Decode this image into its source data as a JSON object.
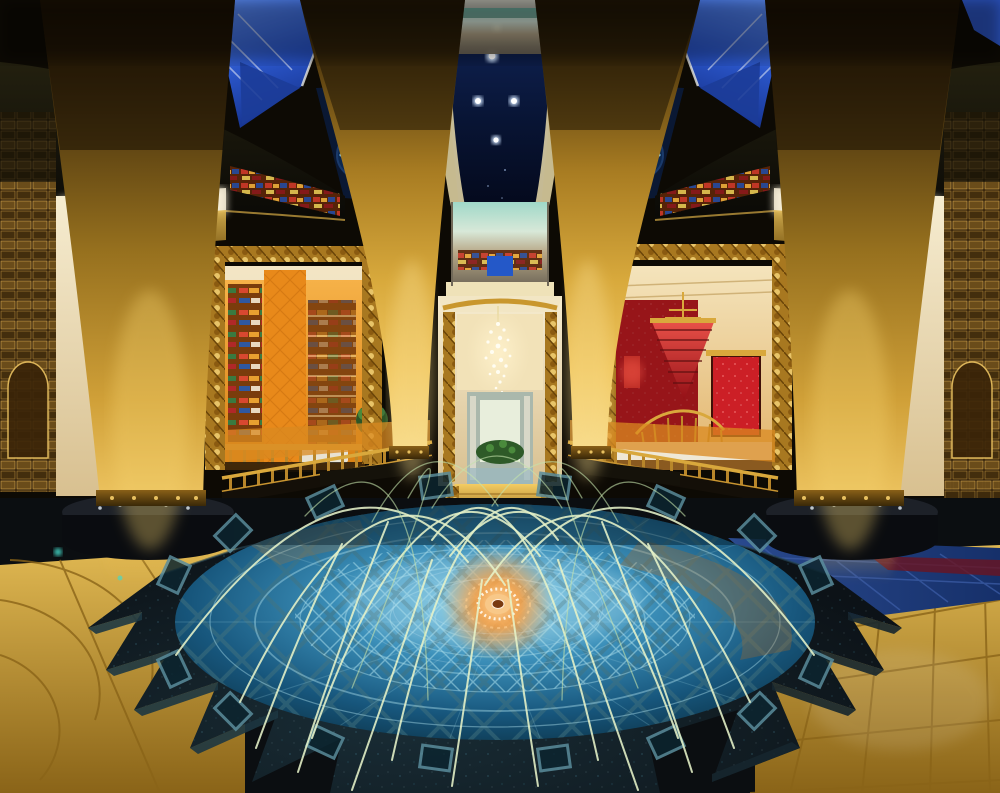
{
  "scene": {
    "type": "photograph",
    "subject": "luxury-hotel-atrium-lobby-with-fountain",
    "counts": {
      "gold-tapered-columns": 4,
      "water-jets": 23,
      "fountain-rim-tiles": 16,
      "ceiling-downlights": 5,
      "skylight-panels": 2,
      "snowflake-ceiling-lights": 2,
      "column-base-discs": 2
    }
  },
  "palette": {
    "gold_light": "#f8dc8c",
    "gold_mid": "#d8a93c",
    "gold_dark": "#5a4010",
    "gold_deep": "#241806",
    "ceiling_navy": "#12265c",
    "void_deep": "#04091c",
    "sky_blue": "#5a8af0",
    "sky_blue_deep": "#16338e",
    "beam_cream": "#f5ecca",
    "snowflake_cyan": "#bfeaff",
    "canopy_dark": "#0a0906",
    "backlit_cream": "#f8f0d8",
    "boutique_orange": "#f8b54c",
    "boutique_orange_deep": "#d87f12",
    "lounge_cream": "#f4e4bc",
    "lounge_red": "#c41a22",
    "lounge_red_deep": "#941016",
    "chandelier_glow": "#fff2cc",
    "frame_gold": "#caa040",
    "walkway_gold": "#f4cc62",
    "pool_bright": "#8fd4ec",
    "pool_mid": "#3c90ba",
    "pool_deep": "#0a2e40",
    "lattice_blue": "#a8dce8",
    "rosette_orange": "#ff9c38",
    "rosette_core": "#ffd9a0",
    "granite_dark": "#0a0e12",
    "granite_blue": "#1c333d",
    "floor_gold": "#e0b852",
    "floor_gold_deep": "#8a6418",
    "floor_blue": "#2a4a8e",
    "jet_green": "#e6f3c8",
    "chrome_teal": "#9fd8c8",
    "mirror_silver": "#a8a89e"
  }
}
